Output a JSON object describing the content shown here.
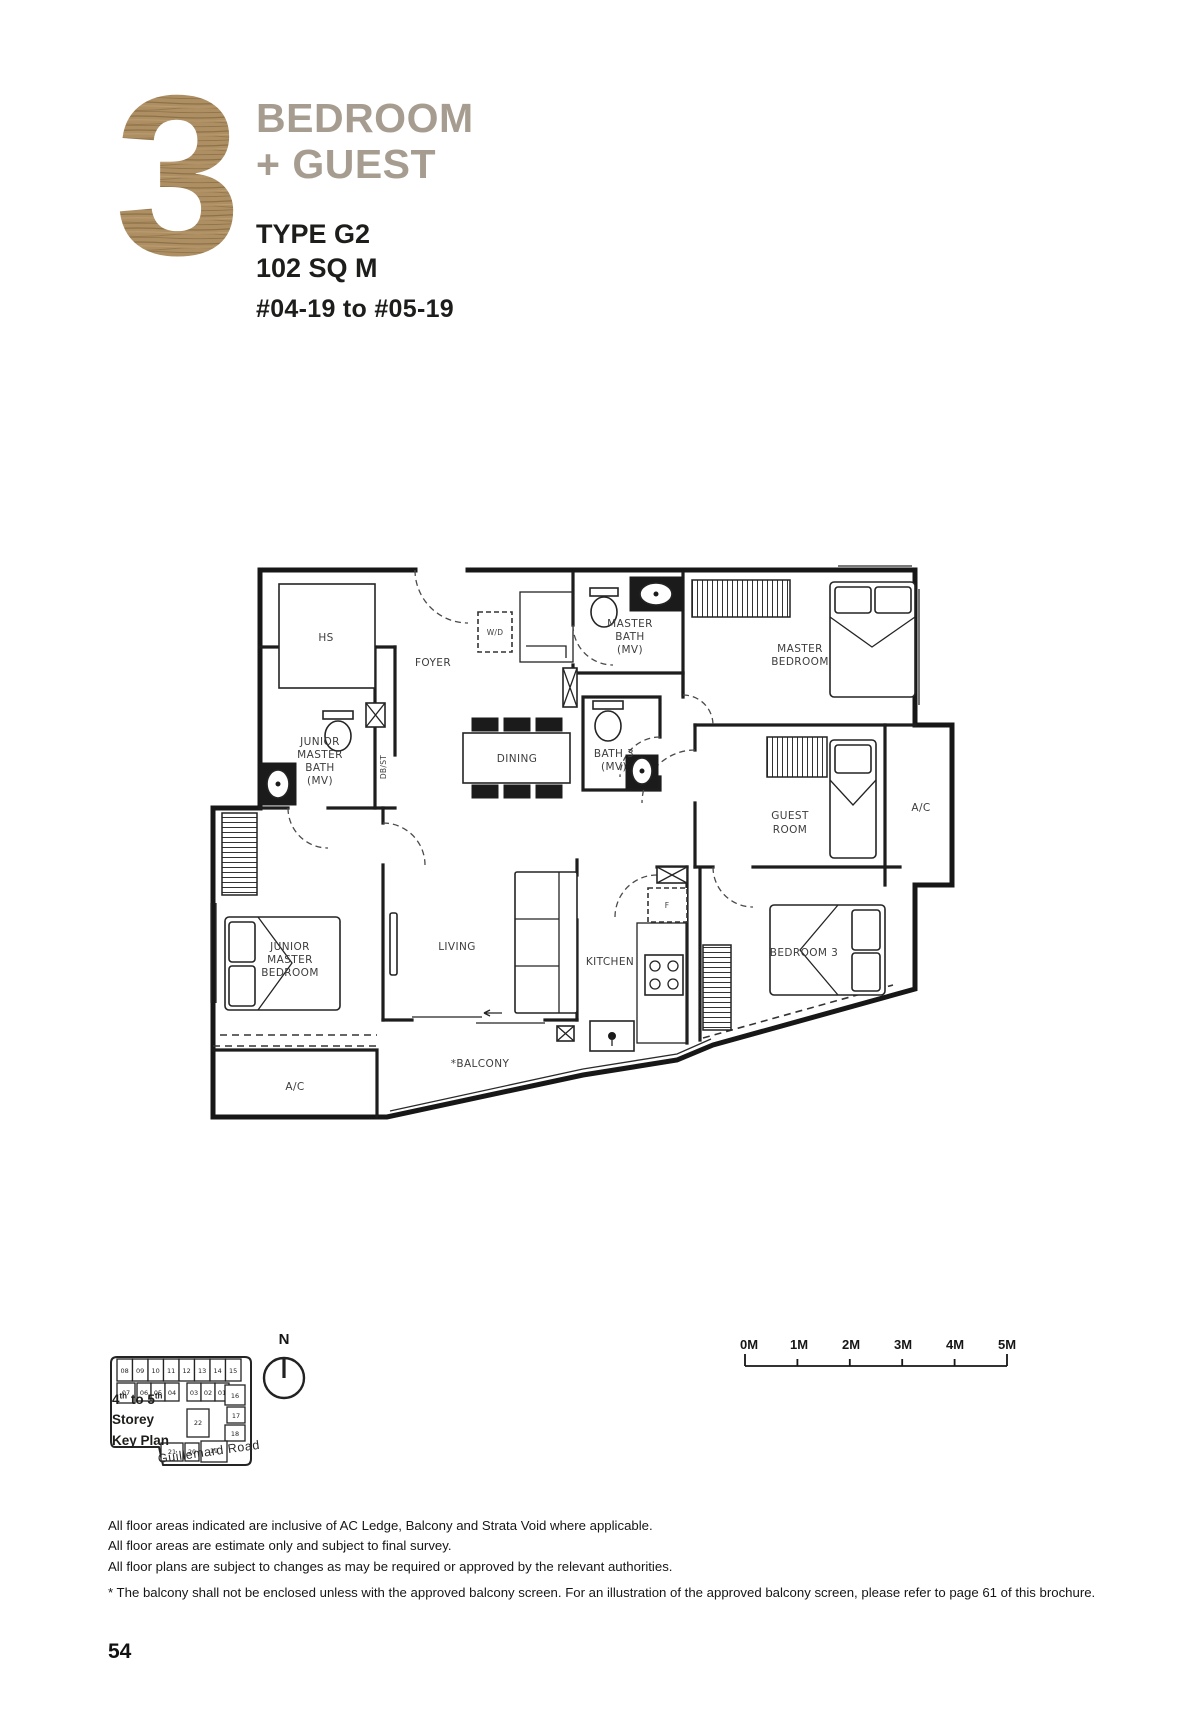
{
  "header": {
    "big_number": "3",
    "title_line1": "BEDROOM",
    "title_line2": "+ GUEST",
    "type": "TYPE G2",
    "area": "102 SQ M",
    "units": "#04-19 to #05-19"
  },
  "plan": {
    "labels": {
      "hs": "HS",
      "foyer": "FOYER",
      "wd": "W/D",
      "master_bath": [
        "MASTER",
        "BATH",
        "(MV)"
      ],
      "master_bedroom": [
        "MASTER",
        "BEDROOM"
      ],
      "junior_master_bath": [
        "JUNIOR",
        "MASTER",
        "BATH",
        "(MV)"
      ],
      "dbst": "DB/ST",
      "dining": "DINING",
      "bath3": [
        "BATH 3",
        "(MV)"
      ],
      "guest_room": [
        "GUEST",
        "ROOM"
      ],
      "ac_right": "A/C",
      "junior_master_bedroom": [
        "JUNIOR",
        "MASTER",
        "BEDROOM"
      ],
      "living": "LIVING",
      "kitchen": "KITCHEN",
      "fridge": "F",
      "bedroom3": "BEDROOM 3",
      "ac_bottom": "A/C",
      "balcony": "*BALCONY"
    }
  },
  "key_plan": {
    "storey_prefix": "4",
    "storey_sup1": "th",
    "storey_mid": " to 5",
    "storey_sup2": "th",
    "title_line2": "Storey",
    "title_line3": "Key Plan",
    "road": "Guillemard Road",
    "compass": "N",
    "row1": [
      "08",
      "09",
      "10",
      "11",
      "12",
      "13",
      "14",
      "15"
    ],
    "row2": [
      "07",
      "06",
      "05",
      "04",
      "03",
      "02",
      "01"
    ],
    "col_right": [
      "16",
      "17",
      "18"
    ],
    "center": "22",
    "row_bottom": [
      "21",
      "20",
      "19"
    ],
    "highlighted_unit": "19"
  },
  "scale_bar": {
    "labels": [
      "0M",
      "1M",
      "2M",
      "3M",
      "4M",
      "5M"
    ]
  },
  "footer": {
    "notes": [
      "All floor areas indicated are inclusive of AC Ledge, Balcony and Strata Void where applicable.",
      "All floor areas are estimate only and subject to final survey.",
      "All floor plans are subject to changes as may be required or approved by the relevant authorities."
    ],
    "balcony_note": "* The balcony shall not be enclosed unless with the approved balcony screen. For an illustration of the approved balcony screen, please refer to page 61 of this brochure.",
    "page_number": "54"
  },
  "colors": {
    "wood": "#ad8f63",
    "wood_dark": "#8d7147",
    "title_gray": "#a69d90",
    "highlight": "#b9a587",
    "ink": "#1c1c1c"
  }
}
